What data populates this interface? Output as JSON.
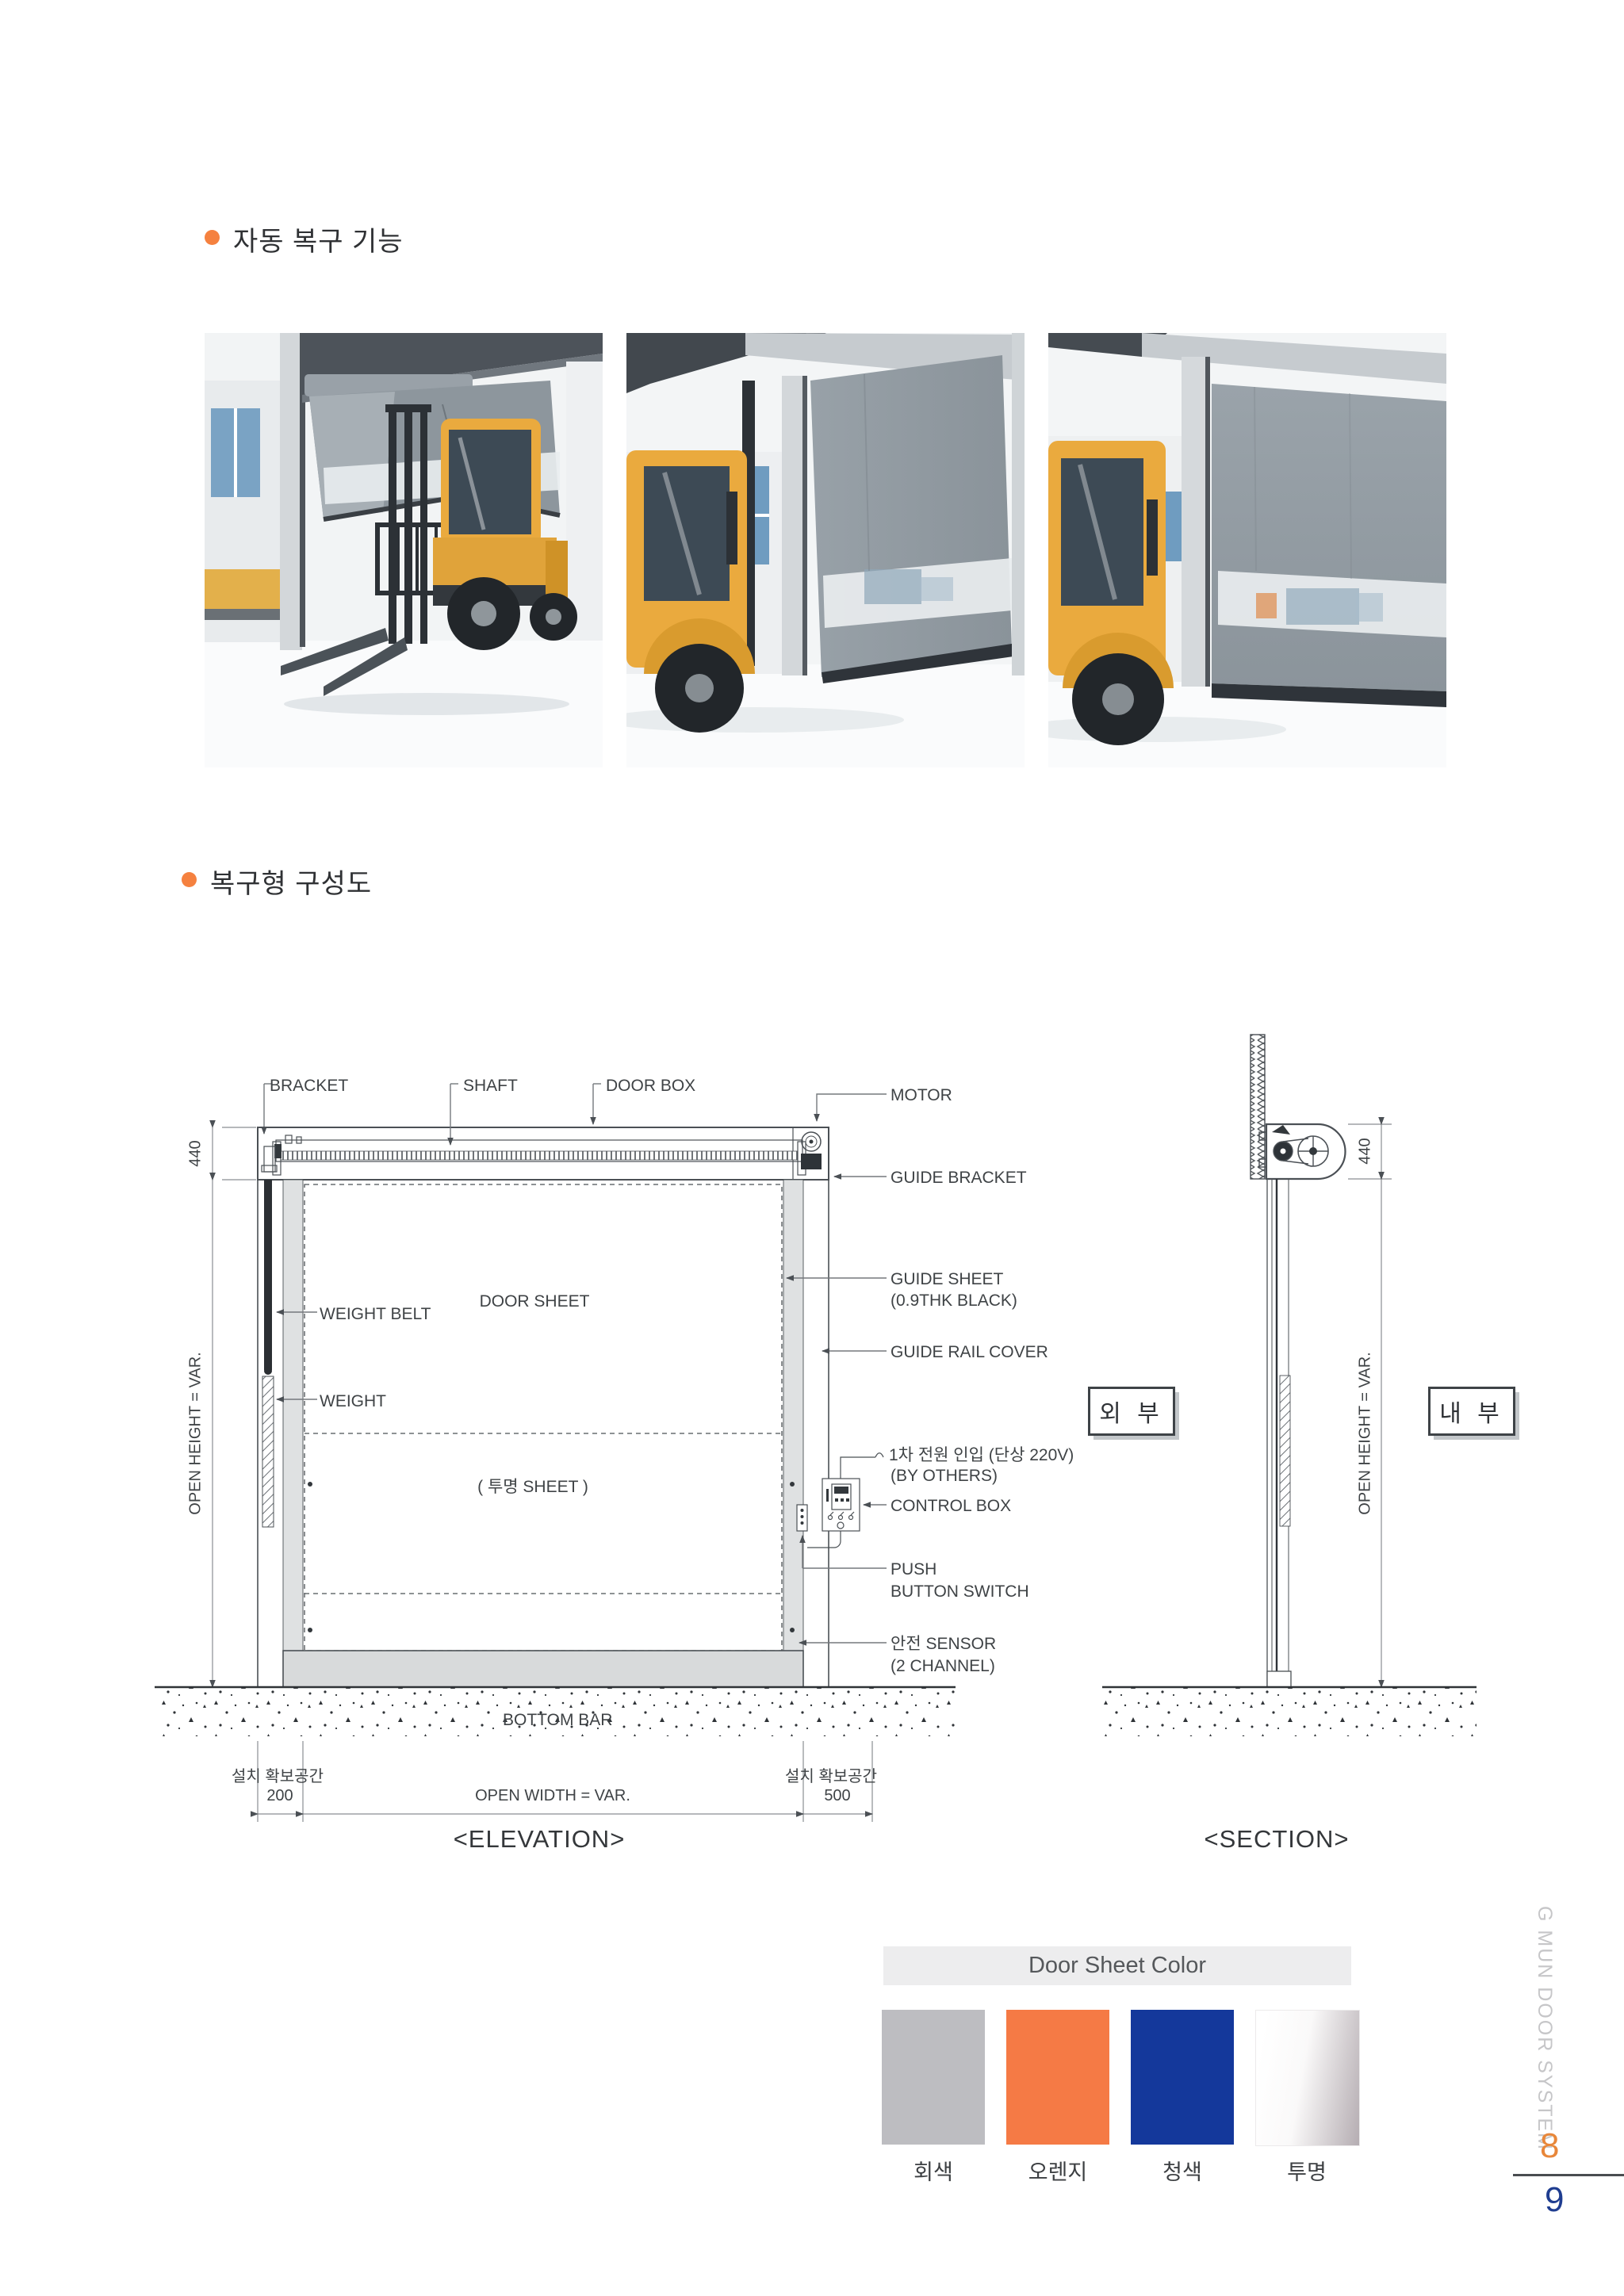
{
  "page": {
    "background": "#ffffff",
    "accent_orange": "#f5813f"
  },
  "sections": {
    "auto_recovery": {
      "title": "자동 복구 기능"
    },
    "diagram": {
      "title": "복구형 구성도"
    }
  },
  "photos": [
    {
      "label": "forklift-impact-through-door"
    },
    {
      "label": "door-sheet-released"
    },
    {
      "label": "door-recovered-closed"
    }
  ],
  "elevation": {
    "caption": "<ELEVATION>",
    "top_labels": {
      "bracket": "BRACKET",
      "shaft": "SHAFT",
      "door_box": "DOOR BOX"
    },
    "right_labels": {
      "motor": "MOTOR",
      "guide_bracket": "GUIDE BRACKET",
      "guide_sheet_1": "GUIDE SHEET",
      "guide_sheet_2": "(0.9THK BLACK)",
      "guide_rail_cover": "GUIDE RAIL COVER",
      "power_1": "1차 전원 인입 (단상 220V)",
      "power_2": "(BY OTHERS)",
      "control_box": "CONTROL BOX",
      "push_1": "PUSH",
      "push_2": "BUTTON SWITCH",
      "sensor_1": "안전 SENSOR",
      "sensor_2": "(2 CHANNEL)"
    },
    "inner_labels": {
      "door_sheet": "DOOR SHEET",
      "clear_sheet": "( 투명 SHEET )",
      "weight_belt": "WEIGHT BELT",
      "weight": "WEIGHT",
      "bottom_bar": "BOTTOM BAR"
    },
    "dims": {
      "box_height": "440",
      "open_height": "OPEN HEIGHT = VAR.",
      "open_width": "OPEN WIDTH = VAR.",
      "left_clear": "200",
      "right_clear": "500",
      "install_space_left": "설치 확보공간",
      "install_space_right": "설치 확보공간"
    }
  },
  "section_view": {
    "caption": "<SECTION>",
    "exterior": "외 부",
    "interior": "내 부",
    "dims": {
      "box_height": "440",
      "open_height": "OPEN HEIGHT = VAR."
    }
  },
  "color_chart": {
    "title": "Door Sheet Color",
    "swatches": [
      {
        "label": "회색",
        "color": "#bdbdc1"
      },
      {
        "label": "오렌지",
        "color": "#f57a45"
      },
      {
        "label": "청색",
        "color": "#14389b"
      },
      {
        "label": "투명",
        "color": "white-to-gray gradient"
      }
    ]
  },
  "sidebar": {
    "vertical_text": "G MUN DOOR SYSTEM",
    "page_current": "8",
    "page_next": "9",
    "page_current_color": "#e8873a",
    "page_next_color": "#1f3d90"
  }
}
